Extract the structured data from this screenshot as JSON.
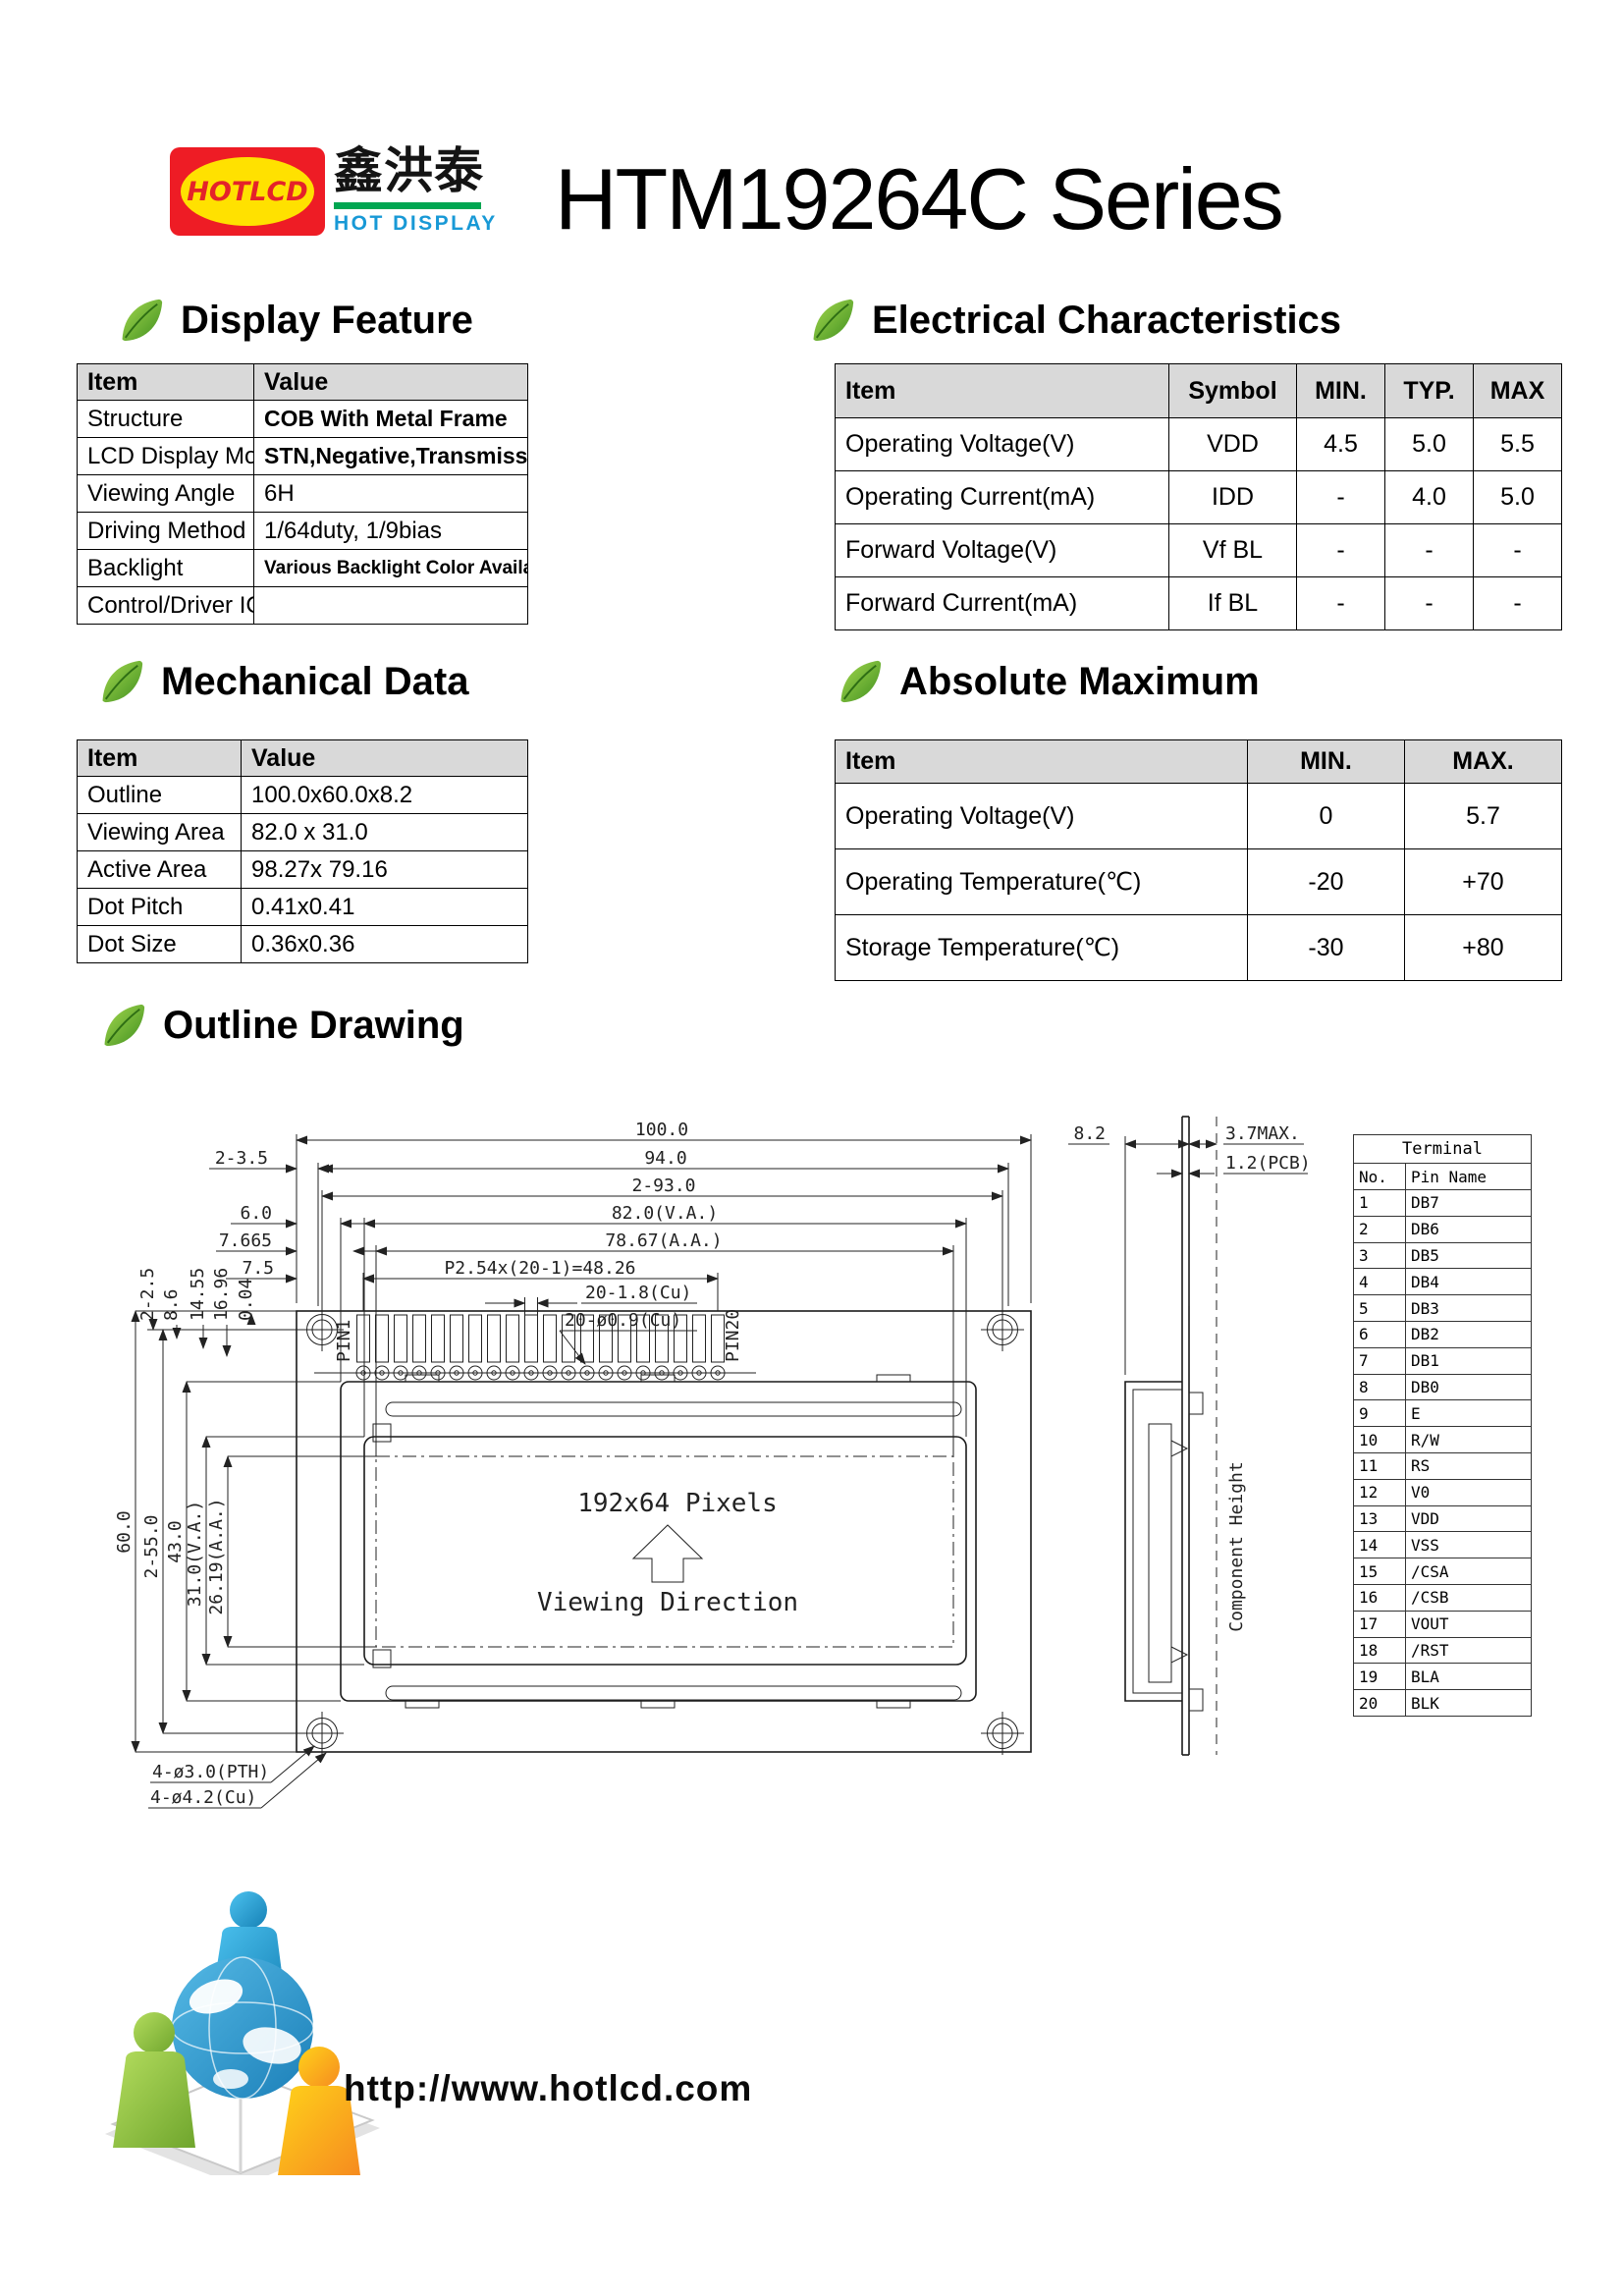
{
  "header": {
    "logo": {
      "badge_text": "HOTLCD",
      "chinese": "鑫洪泰",
      "subtitle": "HOT DISPLAY"
    },
    "title": "HTM19264C Series"
  },
  "colors": {
    "logo_red": "#ee1c25",
    "logo_yellow": "#ffe100",
    "logo_green": "#00a651",
    "logo_blue": "#1899d6",
    "table_header_gray": "#d9d9d9"
  },
  "icons": {
    "section_bullet": "leaf-icon",
    "footer": "globe-people-logo"
  },
  "sections": {
    "display_feature": {
      "title": "Display Feature",
      "table": {
        "headers": [
          "Item",
          "Value"
        ],
        "rows": [
          {
            "item": "Structure",
            "value": "COB With Metal Frame"
          },
          {
            "item": "LCD Display Mode",
            "value": "STN,Negative,Transmissive"
          },
          {
            "item": "Viewing Angle",
            "value": "6H"
          },
          {
            "item": "Driving Method",
            "value": "1/64duty, 1/9bias"
          },
          {
            "item": "Backlight",
            "value": "Various Backlight Color Available"
          },
          {
            "item": "Control/Driver IC",
            "value": ""
          }
        ]
      }
    },
    "electrical": {
      "title": "Electrical Characteristics",
      "table": {
        "headers": [
          "Item",
          "Symbol",
          "MIN.",
          "TYP.",
          "MAX"
        ],
        "rows": [
          {
            "item": "Operating Voltage(V)",
            "symbol": "VDD",
            "min": "4.5",
            "typ": "5.0",
            "max": "5.5"
          },
          {
            "item": "Operating Current(mA)",
            "symbol": "IDD",
            "min": "-",
            "typ": "4.0",
            "max": "5.0"
          },
          {
            "item": "Forward Voltage(V)",
            "symbol": "Vf BL",
            "min": "-",
            "typ": "-",
            "max": "-"
          },
          {
            "item": "Forward Current(mA)",
            "symbol": "If BL",
            "min": "-",
            "typ": "-",
            "max": "-"
          }
        ]
      }
    },
    "mechanical": {
      "title": "Mechanical Data",
      "table": {
        "headers": [
          "Item",
          "Value"
        ],
        "rows": [
          {
            "item": "Outline",
            "value": "100.0x60.0x8.2"
          },
          {
            "item": "Viewing Area",
            "value": "82.0 x 31.0"
          },
          {
            "item": "Active Area",
            "value": "98.27x 79.16"
          },
          {
            "item": "Dot Pitch",
            "value": "0.41x0.41"
          },
          {
            "item": "Dot Size",
            "value": "0.36x0.36"
          }
        ]
      }
    },
    "absolute_maximum": {
      "title": "Absolute Maximum",
      "table": {
        "headers": [
          "Item",
          "MIN.",
          "MAX."
        ],
        "rows": [
          {
            "item": "Operating Voltage(V)",
            "min": "0",
            "max": "5.7"
          },
          {
            "item": "Operating Temperature(℃)",
            "min": "-20",
            "max": "+70"
          },
          {
            "item": "Storage Temperature(℃)",
            "min": "-30",
            "max": "+80"
          }
        ]
      }
    },
    "outline_drawing": {
      "title": "Outline Drawing"
    }
  },
  "drawing": {
    "top_dims": [
      "100.0",
      "94.0",
      "2-93.0",
      "82.0(V.A.)",
      "78.67(A.A.)",
      "P2.54x(20-1)=48.26",
      "20-1.8(Cu)",
      "20-ø0.9(Cu)"
    ],
    "left_dims": [
      "2-3.5",
      "6.0",
      "7.665",
      "7.5"
    ],
    "rotated_dims": [
      "2-2.5",
      "8.6",
      "14.55",
      "16.96",
      "0.04"
    ],
    "vertical_dims": [
      "60.0",
      "2-55.0",
      "43.0",
      "31.0(V.A.)",
      "26.19(A.A.)"
    ],
    "pin_labels": {
      "pin1": "PIN1",
      "pin20": "PIN20"
    },
    "display_text": {
      "pixels": "192x64 Pixels",
      "viewing": "Viewing Direction"
    },
    "hole_callouts": [
      "4-ø3.0(PTH)",
      "4-ø4.2(Cu)"
    ],
    "side_dims": [
      "8.2",
      "3.7MAX.",
      "1.2(PCB)"
    ],
    "component_height": "Component Height",
    "terminal": {
      "title": "Terminal",
      "headers": [
        "No.",
        "Pin Name"
      ],
      "rows": [
        {
          "no": "1",
          "name": "DB7"
        },
        {
          "no": "2",
          "name": "DB6"
        },
        {
          "no": "3",
          "name": "DB5"
        },
        {
          "no": "4",
          "name": "DB4"
        },
        {
          "no": "5",
          "name": "DB3"
        },
        {
          "no": "6",
          "name": "DB2"
        },
        {
          "no": "7",
          "name": "DB1"
        },
        {
          "no": "8",
          "name": "DB0"
        },
        {
          "no": "9",
          "name": "E"
        },
        {
          "no": "10",
          "name": "R/W"
        },
        {
          "no": "11",
          "name": "RS"
        },
        {
          "no": "12",
          "name": "V0"
        },
        {
          "no": "13",
          "name": "VDD"
        },
        {
          "no": "14",
          "name": "VSS"
        },
        {
          "no": "15",
          "name": "/CSA"
        },
        {
          "no": "16",
          "name": "/CSB"
        },
        {
          "no": "17",
          "name": "VOUT"
        },
        {
          "no": "18",
          "name": "/RST"
        },
        {
          "no": "19",
          "name": "BLA"
        },
        {
          "no": "20",
          "name": "BLK"
        }
      ]
    }
  },
  "footer": {
    "url": "http://www.hotlcd.com"
  }
}
